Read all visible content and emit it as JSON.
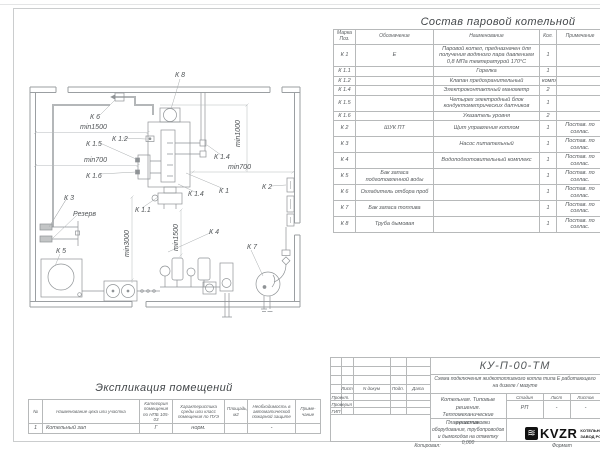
{
  "composition": {
    "title": "Состав паровой котельной",
    "headers": {
      "mark": "Марка Поз.",
      "designation": "Обозначение",
      "name": "Наименование",
      "qty": "Кол.",
      "note": "Примечание"
    },
    "rows": [
      {
        "mark": "К 1",
        "designation": "Е",
        "name": "Паровой котел, предназначен для получения водяного пара давлением 0,8 МПа температурой 170°С",
        "qty": "1",
        "note": ""
      },
      {
        "mark": "К 1.1",
        "designation": "",
        "name": "Горелка",
        "qty": "1",
        "note": ""
      },
      {
        "mark": "К 1.2",
        "designation": "",
        "name": "Клапан предохранительный",
        "qty": "компл.",
        "note": ""
      },
      {
        "mark": "К 1.4",
        "designation": "",
        "name": "Электроконтактный манометр",
        "qty": "2",
        "note": ""
      },
      {
        "mark": "К 1.5",
        "designation": "",
        "name": "Четырех электродный блок кондуктометрических датчиков",
        "qty": "1",
        "note": ""
      },
      {
        "mark": "К 1.6",
        "designation": "",
        "name": "Указатель уровня",
        "qty": "2",
        "note": ""
      },
      {
        "mark": "К 2",
        "designation": "ШУК ПТ",
        "name": "Щит управления котлом",
        "qty": "1",
        "note": "Постав. по соглас."
      },
      {
        "mark": "К 3",
        "designation": "",
        "name": "Насос питательный",
        "qty": "1",
        "note": "Постав. по соглас."
      },
      {
        "mark": "К 4",
        "designation": "",
        "name": "Водоподготовительный комплекс",
        "qty": "1",
        "note": "Постав. по соглас."
      },
      {
        "mark": "К 5",
        "designation": "Бак запаса подготовленной воды",
        "name": "",
        "qty": "1",
        "note": "Постав. по соглас."
      },
      {
        "mark": "К 6",
        "designation": "Охладитель отбора проб",
        "name": "",
        "qty": "1",
        "note": "Постав. по соглас."
      },
      {
        "mark": "К 7",
        "designation": "Бак запаса топлива",
        "name": "",
        "qty": "1",
        "note": "Постав. по соглас."
      },
      {
        "mark": "К 8",
        "designation": "Труба дымовая",
        "name": "",
        "qty": "1",
        "note": "Постав. по соглас."
      }
    ]
  },
  "explication": {
    "title": "Экспликация помещений",
    "headers": {
      "num": "№",
      "name": "Наименование цеха или участка",
      "category": "Категория помещения по НПБ 105-03",
      "env": "Характеристика среды или класс помещения по ПУЭ",
      "area": "Площадь, м2",
      "fire": "Необходимость в автоматической пожарной защите",
      "note": "Приме- чание"
    },
    "rows": [
      {
        "num": "1",
        "name": "Котельный зал",
        "category": "Г",
        "env": "норм.",
        "area": "",
        "fire": "-",
        "note": ""
      }
    ]
  },
  "title_block": {
    "doc_number": "КУ-П-00-ТМ",
    "description": "Схема подключения жидкотопливного котла типа Е работающего на дизеле / мазуте",
    "col_sheet": "Лист",
    "col_doc": "N докум",
    "col_sign": "Подп.",
    "col_date": "Дата",
    "role_design": "Проект.",
    "role_check": "Проверил",
    "role_gip": "ГИП",
    "project_line1": "Котельная. Типовые решения.",
    "project_line2": "Тепломеханические решения.",
    "stage_label": "Стадия",
    "sheet_label": "Лист",
    "sheets_label": "Листов",
    "stage_value": "РП",
    "sheet_value": "-",
    "sheets_value": "-",
    "sheet_title": "План расстановки оборудования, трубопроводов и дымоходов на отметку 0,000",
    "logo_glyph": "≋",
    "logo_text": "KVZR",
    "company_line1": "КОТЕЛЬНЫЙ",
    "company_line2": "ЗАВОД РОССИИ",
    "copied_label": "Копировал:",
    "format_label": "Формат"
  },
  "plan": {
    "labels": [
      {
        "text": "К 8",
        "x": 155,
        "y": 22
      },
      {
        "text": "К 6",
        "x": 70,
        "y": 64
      },
      {
        "text": "min1500",
        "x": 60,
        "y": 74
      },
      {
        "text": "К 1.2",
        "x": 92,
        "y": 86
      },
      {
        "text": "К 1.5",
        "x": 66,
        "y": 91
      },
      {
        "text": "min700",
        "x": 64,
        "y": 107
      },
      {
        "text": "К 1.6",
        "x": 66,
        "y": 123
      },
      {
        "text": "min1000",
        "x": 220,
        "y": 92,
        "rotate": -90
      },
      {
        "text": "К 1.4",
        "x": 194,
        "y": 104
      },
      {
        "text": "min700",
        "x": 208,
        "y": 114
      },
      {
        "text": "К 2",
        "x": 242,
        "y": 134
      },
      {
        "text": "К 1",
        "x": 199,
        "y": 138
      },
      {
        "text": "К 1.4",
        "x": 168,
        "y": 141
      },
      {
        "text": "К 3",
        "x": 44,
        "y": 145
      },
      {
        "text": "Резерв",
        "x": 53,
        "y": 161
      },
      {
        "text": "К 1.1",
        "x": 115,
        "y": 157
      },
      {
        "text": "min3000",
        "x": 109,
        "y": 202,
        "rotate": -90
      },
      {
        "text": "min1500",
        "x": 158,
        "y": 196,
        "rotate": -90
      },
      {
        "text": "К 4",
        "x": 189,
        "y": 179
      },
      {
        "text": "К 5",
        "x": 36,
        "y": 198
      },
      {
        "text": "К 7",
        "x": 227,
        "y": 194
      }
    ]
  }
}
